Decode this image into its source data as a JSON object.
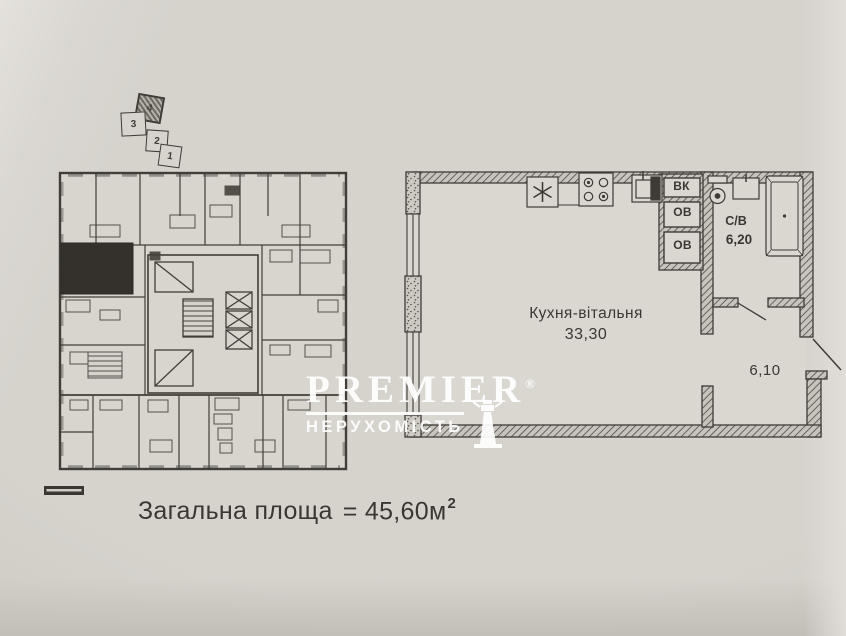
{
  "document_type": "apartment floor plan photo",
  "overview_plan": {
    "description": "building storey plan with highlighted unit",
    "locator_squares": [
      {
        "num": "4",
        "filled": true
      },
      {
        "num": "3",
        "filled": false
      },
      {
        "num": "2",
        "filled": false
      },
      {
        "num": "1",
        "filled": false
      }
    ]
  },
  "apartment_plan": {
    "room_kitchen_living": {
      "name": "Кухня-вітальня",
      "area": "33,30"
    },
    "room_bathroom": {
      "name": "С/В",
      "area": "6,20"
    },
    "room_hall": {
      "area": "6,10"
    },
    "shaft_labels": {
      "vk": "ВК",
      "ov1": "ОВ",
      "ov2": "ОВ"
    },
    "fixtures": [
      "fridge",
      "stove",
      "sink",
      "toilet",
      "washbasin",
      "bathtub"
    ]
  },
  "watermark": {
    "brand": "PREMIER",
    "registered": "®",
    "subtitle": "НЕРУХОМІСТЬ"
  },
  "footer": {
    "label": "Загальна площа",
    "value": "= 45,60м",
    "sup": "2"
  },
  "colors": {
    "paper": "#d3cfc9",
    "ink": "#3e3b36",
    "highlighted_unit_fill": "#34312c",
    "watermark": "#ffffff"
  }
}
